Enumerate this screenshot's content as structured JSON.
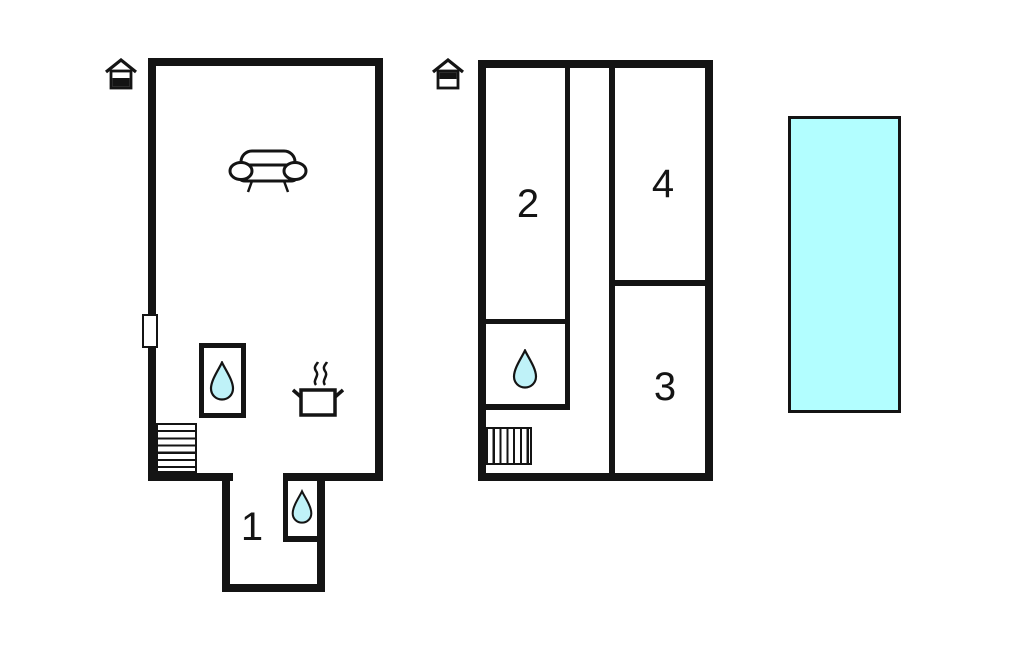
{
  "page": {
    "type": "property-floor-plan",
    "background": "#ffffff"
  },
  "colors": {
    "wall": "#141414",
    "water_drop_fill": "#bff2f8",
    "pool_fill": "#b2feff"
  },
  "floors": [
    {
      "name": "ground-floor",
      "marker_icon": "house-ground-floor-icon",
      "room_labels": [
        "1"
      ],
      "icons": [
        "sofa-icon",
        "stove-icon",
        "water-drop-icon",
        "stairs",
        "window"
      ]
    },
    {
      "name": "upper-floor",
      "marker_icon": "house-upper-floor-icon",
      "room_labels": [
        "2",
        "3",
        "4"
      ],
      "icons": [
        "water-drop-icon",
        "stairs"
      ]
    }
  ],
  "labels": {
    "room1": "1",
    "room2": "2",
    "room3": "3",
    "room4": "4"
  },
  "pool": {
    "name": "swimming-pool"
  }
}
